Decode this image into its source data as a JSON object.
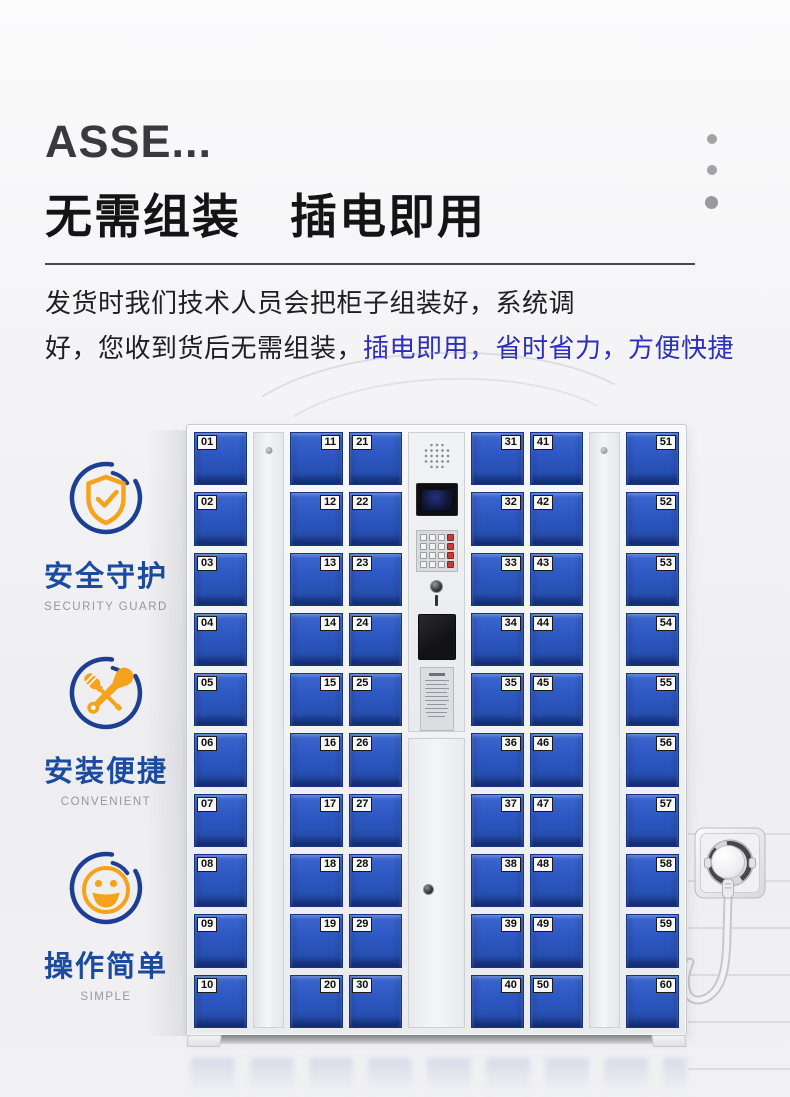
{
  "header": {
    "series_title": "ASSE...",
    "heading": "无需组装　插电即用",
    "description": {
      "line1": "发货时我们技术人员会把柜子组装好，系统调",
      "line2_plain": "好，您收到货后无需组装，",
      "line2_highlight": "插电即用，省时省力，方便快捷"
    }
  },
  "features": [
    {
      "icon": "shield-check-icon",
      "title": "安全守护",
      "subtitle": "SECURITY GUARD"
    },
    {
      "icon": "crossed-tools-icon",
      "title": "安装便捷",
      "subtitle": "CONVENIENT"
    },
    {
      "icon": "smiley-face-icon",
      "title": "操作简单",
      "subtitle": "SIMPLE"
    }
  ],
  "locker_cabinet": {
    "door_columns": [
      {
        "label_side": "left",
        "numbers": [
          "01",
          "02",
          "03",
          "04",
          "05",
          "06",
          "07",
          "08",
          "09",
          "10"
        ]
      },
      {
        "label_side": "right",
        "numbers": [
          "11",
          "12",
          "13",
          "14",
          "15",
          "16",
          "17",
          "18",
          "19",
          "20"
        ]
      },
      {
        "label_side": "left",
        "numbers": [
          "21",
          "22",
          "23",
          "24",
          "25",
          "26",
          "27",
          "28",
          "29",
          "30"
        ]
      },
      {
        "label_side": "right",
        "numbers": [
          "31",
          "32",
          "33",
          "34",
          "35",
          "36",
          "37",
          "38",
          "39",
          "40"
        ]
      },
      {
        "label_side": "left",
        "numbers": [
          "41",
          "42",
          "43",
          "44",
          "45",
          "46",
          "47",
          "48",
          "49",
          "50"
        ]
      },
      {
        "label_side": "right",
        "numbers": [
          "51",
          "52",
          "53",
          "54",
          "55",
          "56",
          "57",
          "58",
          "59",
          "60"
        ]
      }
    ],
    "control_panel_parts": [
      "speaker",
      "display-screen",
      "keypad",
      "key-lock",
      "card-reader",
      "instruction-sticker"
    ]
  },
  "colors": {
    "door_blue": "#2d57c0",
    "highlight_text_blue": "#2e2ebc",
    "feature_title_blue": "#1b4a9e",
    "feature_icon_orange": "#f5a31c",
    "heading_black": "#141414",
    "cabinet_frame": "#eef0f2"
  }
}
